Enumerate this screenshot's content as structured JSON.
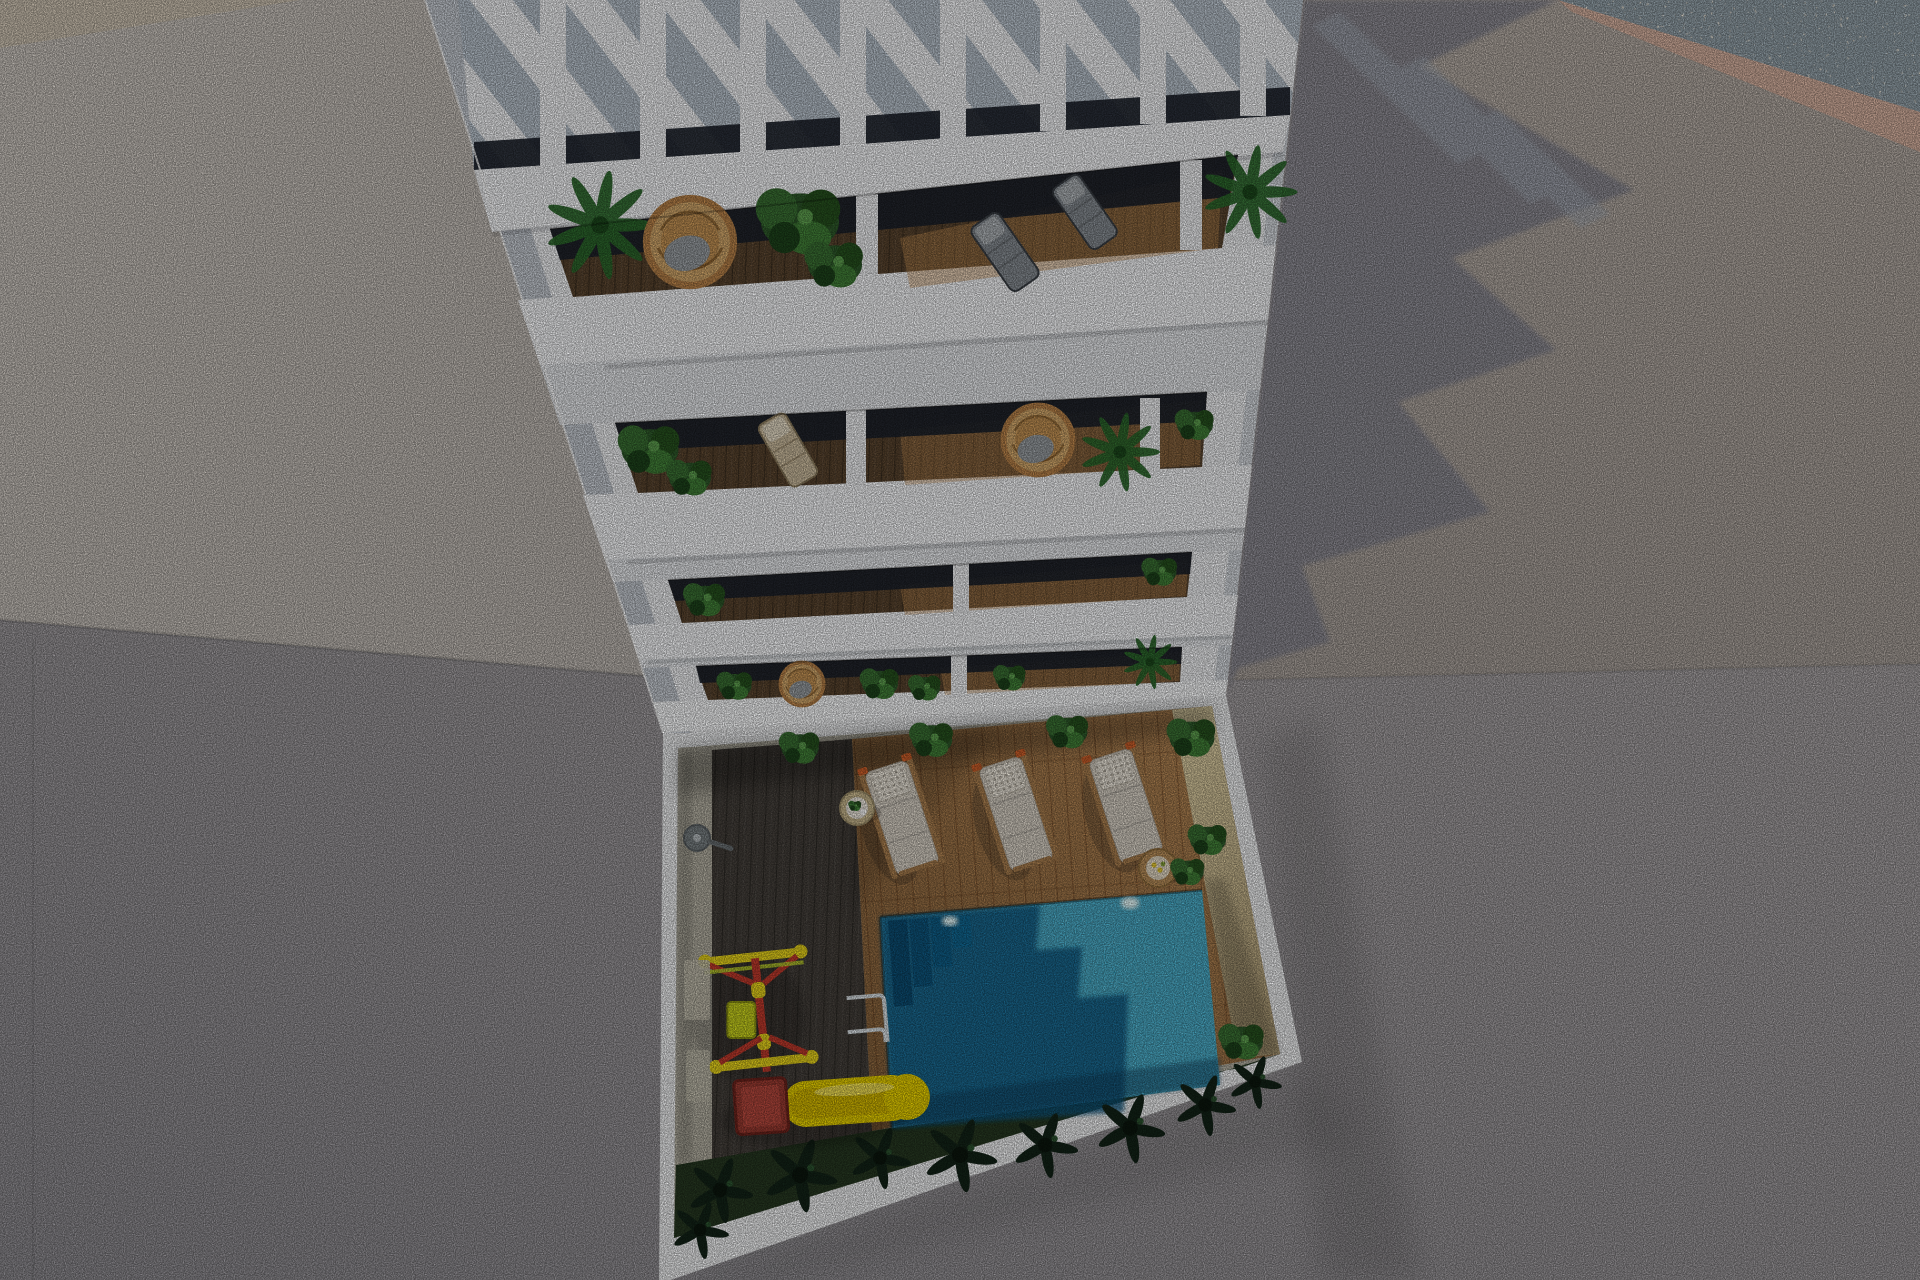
{
  "meta": {
    "title": "Aerial 3D architectural render",
    "aria": "Top-down aerial 3D rendering of a white apartment tower with a rooftop pergola, four rows of balconies with plants and rattan furniture, and a sunken courtyard containing a turquoise swimming pool, three white sun loungers on a wooden deck, a yellow children's slide and swing set, concrete plaza on the left and a long building shadow cast on the grey ground to the right."
  },
  "colors": {
    "plaza": "#c9c3bc",
    "plaza_warm": "#cfc4b3",
    "street": "#a09ca0",
    "ground_right": "#b2a9a2",
    "building_shadow": "#8c8b94",
    "shadow_stripe": "#a6adb8",
    "pebbles": "#9a9b9a",
    "pink_band": "#d7b2a0",
    "building_white": "#f3f4f6",
    "parapet_white": "#f8f9fb",
    "gap_wall": "#e8eaed",
    "side_face": "#c6cbd2",
    "glass_dark": "#1c222b",
    "pergola_sky": "#b9c3cd",
    "balcony_wood": "#5a452f",
    "wood_sunlit": "#c79055",
    "deck_dark": "#45403b",
    "deck_light": "#a87c4e",
    "stone_strip": "#b5b1a3",
    "sand_strip": "#d9c99f",
    "grass": "#273922",
    "water": "#17a5c6",
    "water_shadow": "#0c5680",
    "pool_step": "#0a4a70",
    "chrome": "#dce3e7",
    "slide_yellow": "#e6cf00",
    "slide_cab_red": "#9c3c32",
    "swing_red": "#c23b2d",
    "swing_yellow": "#e7d31c",
    "swing_lime": "#b7c92c",
    "lounger_cushion": "#d8d1c5",
    "lounger_pillow": "#ece6da",
    "lounger_wood": "#aa7f4f",
    "lounger_accent": "#cc5f2a",
    "rattan": "#c89a5e",
    "plant_green": "#39682f",
    "plant_dark": "#16271a",
    "pot_gray": "#8f8f87",
    "table_wood": "#c9b88e"
  },
  "objects": {
    "building": {
      "label": "white apartment tower seen from above",
      "pergola_slats": 8,
      "balcony_rows": 4,
      "units_per_row": 3
    },
    "courtyard": {
      "label": "sunken courtyard with pool deck"
    },
    "pool": {
      "label": "turquoise swimming pool",
      "sparkles": 2,
      "steps": 4,
      "ladders": 1
    },
    "loungers": {
      "count": 3,
      "label": "white sun loungers with waffle pillows"
    },
    "playground": {
      "swing_sets": 1,
      "slides": 1
    },
    "side_tables": 2,
    "potted_plants": 9,
    "shower": 1
  }
}
